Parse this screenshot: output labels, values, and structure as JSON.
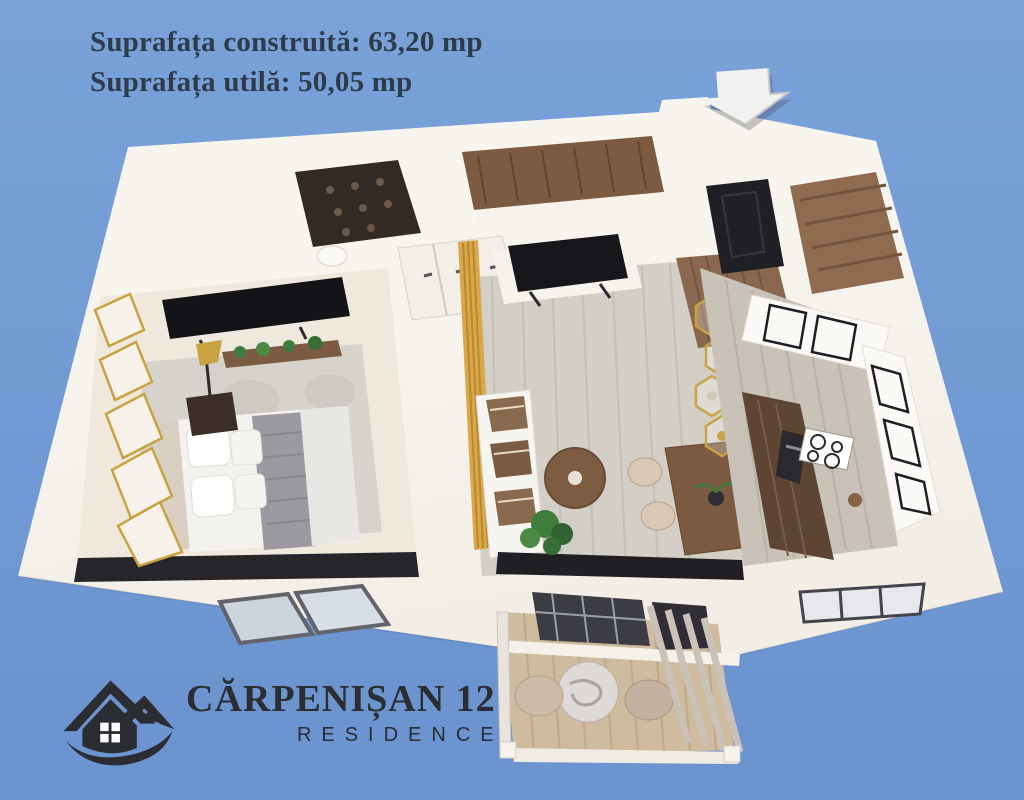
{
  "colors": {
    "sky-top": "#7aa2d9",
    "sky-bottom": "#6a93cf",
    "text": "#2e3b4b",
    "logo": "#2c2c33",
    "arrow": "#f2f2f0",
    "gold": "#c9a242"
  },
  "overlay": {
    "line1": "Suprafața construită: 63,20 mp",
    "line2": "Suprafața utilă: 50,05 mp"
  },
  "logo": {
    "title": "CĂRPENIȘAN 12",
    "subtitle": "RESIDENCE"
  },
  "entrance_arrow": {
    "direction": "down"
  },
  "floorplan": {
    "view": "3d-isometric-apartment-render",
    "rooms": [
      "bedroom",
      "bathroom",
      "wardrobe",
      "hallway",
      "living-room",
      "kitchen",
      "balcony"
    ]
  }
}
